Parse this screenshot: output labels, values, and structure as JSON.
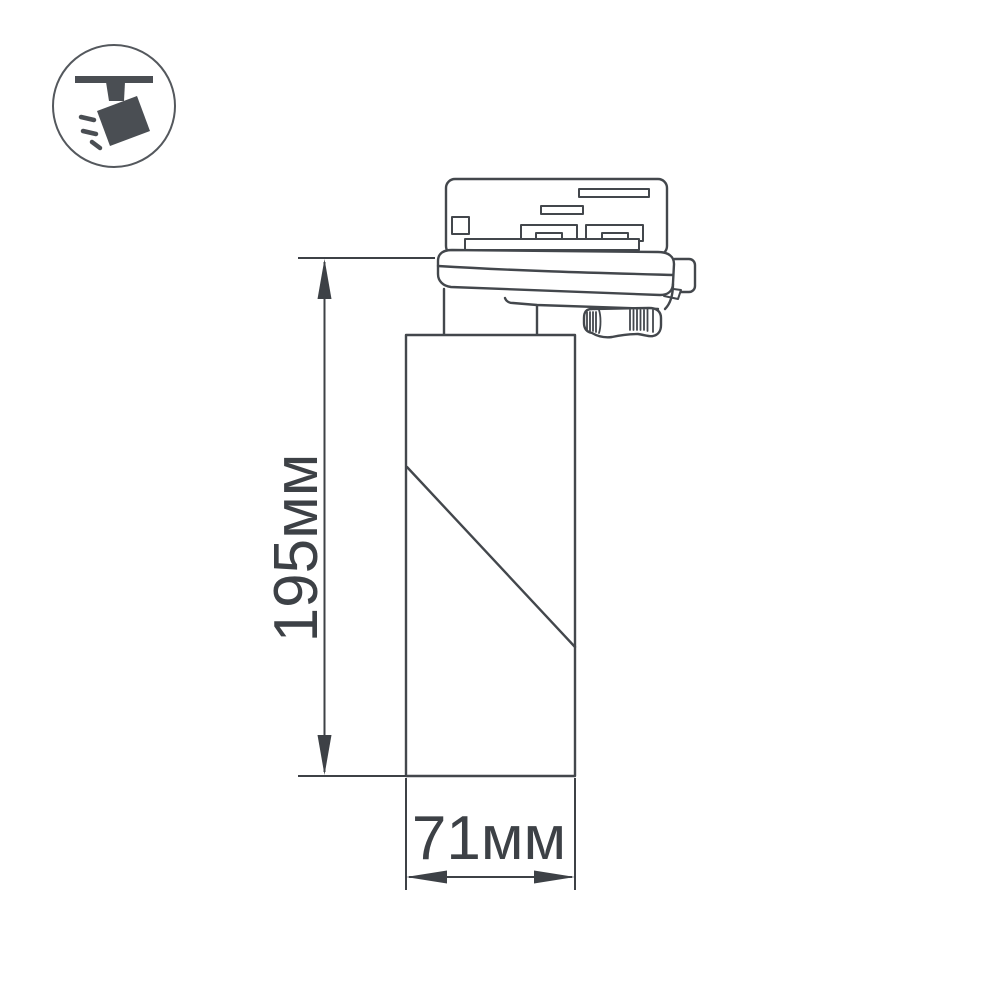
{
  "page": {
    "background_color": "#ffffff",
    "description": "Technical dimension drawing of a track-mounted cylindrical spotlight"
  },
  "style": {
    "line_color": "#43474c",
    "dimension_color": "#3d4146",
    "icon_color": "#4a4e53",
    "badge_ring_color": "#54585d"
  },
  "badge": {
    "icon": "ceiling-track-spotlight-icon"
  },
  "drawing": {
    "subject": "track spotlight side view with track adapter, locking knob and cylindrical lamp body",
    "dimensions": {
      "height": {
        "label": "195мм",
        "value_mm": 195
      },
      "width": {
        "label": "71мм",
        "value_mm": 71
      }
    }
  }
}
